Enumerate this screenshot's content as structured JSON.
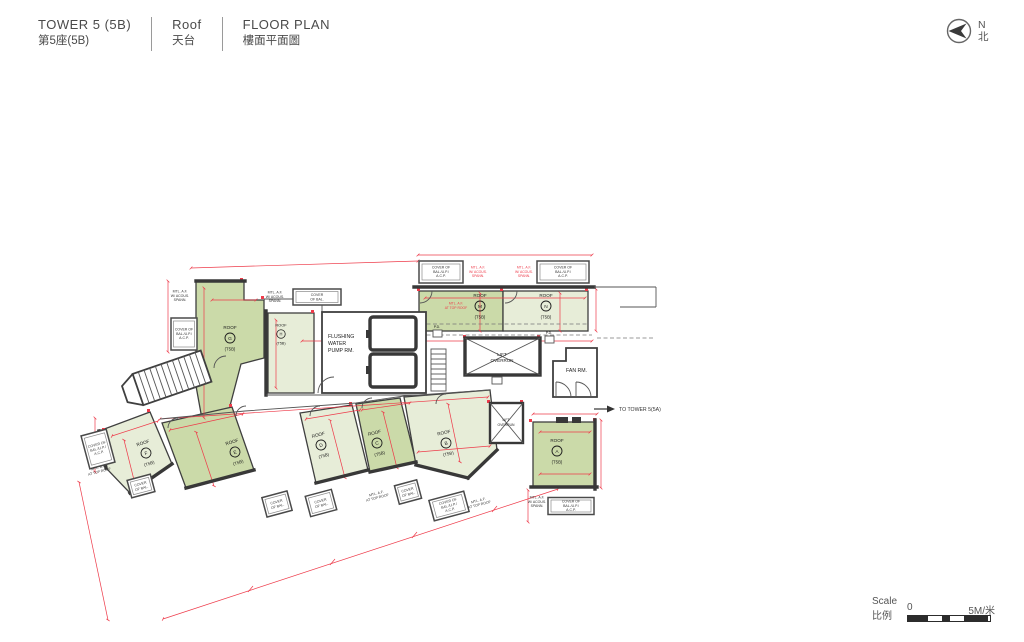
{
  "header": {
    "tower_en": "TOWER 5 (5B)",
    "tower_zh": "第5座(5B)",
    "level_en": "Roof",
    "level_zh": "天台",
    "plan_en": "FLOOR PLAN",
    "plan_zh": "樓面平面圖"
  },
  "north": {
    "en": "N",
    "zh": "北"
  },
  "scale": {
    "en": "Scale",
    "zh": "比例",
    "zero": "0",
    "max": "5M/米"
  },
  "colors": {
    "roof_dark": "#cbdaa9",
    "roof_light": "#e7edd8",
    "dim_red": "#ee3b4a",
    "wall": "#383838"
  },
  "plan": {
    "roof_word": "ROOF",
    "roof_code": "(T5B)",
    "roofs": [
      {
        "letter": "G"
      },
      {
        "letter": "H"
      },
      {
        "letter": "M"
      },
      {
        "letter": "N"
      },
      {
        "letter": "F"
      },
      {
        "letter": "E"
      },
      {
        "letter": "D"
      },
      {
        "letter": "C"
      },
      {
        "letter": "B"
      },
      {
        "letter": "A"
      }
    ],
    "rooms": {
      "pump": [
        "FLUSHING",
        "WATER",
        "PUMP RM."
      ],
      "lift": [
        "LIFT",
        "OVERRUN"
      ],
      "fan": "FAN RM.",
      "pd": "P.D."
    },
    "labels": {
      "cover_full": [
        "COVER OF",
        "BAL./U.P./",
        "A.C.P."
      ],
      "cover_bal": [
        "COVER",
        "OF BAL."
      ],
      "mtl_spann": [
        "MTL. A.F.",
        "W/ ACOUS.",
        "SPANN."
      ],
      "mtl_top": [
        "MTL. A.F.",
        "AT TOP ROOF"
      ],
      "to_tower": "TO TOWER 5(5A)"
    }
  }
}
